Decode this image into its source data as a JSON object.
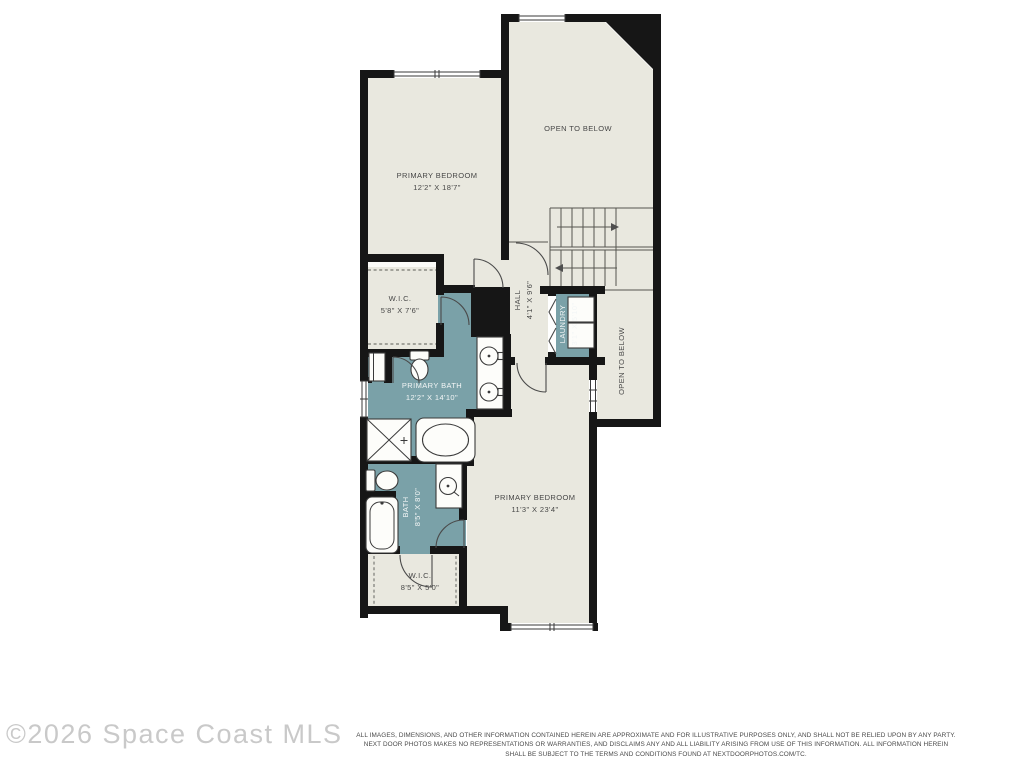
{
  "rooms": {
    "primary_bedroom_upper": {
      "name": "PRIMARY BEDROOM",
      "dims": "12'2\" X 18'7\""
    },
    "open_to_below_upper": {
      "name": "OPEN TO BELOW"
    },
    "wic_upper": {
      "name": "W.I.C.",
      "dims": "5'8\" X 7'6\""
    },
    "hall": {
      "name": "HALL",
      "dims": "4'1\" X 9'6\""
    },
    "laundry": {
      "name": "LAUNDRY",
      "dims": "3'1\" X 5'10\""
    },
    "open_to_below_right": {
      "name": "OPEN TO BELOW"
    },
    "primary_bath": {
      "name": "PRIMARY BATH",
      "dims": "12'2\" X 14'10\""
    },
    "bath": {
      "name": "BATH",
      "dims": "8'5\" X 8'0\""
    },
    "primary_bedroom_lower": {
      "name": "PRIMARY BEDROOM",
      "dims": "11'3\" X 23'4\""
    },
    "wic_lower": {
      "name": "W.I.C.",
      "dims": "8'5\" X 5'0\""
    }
  },
  "watermark": "©2026 Space Coast MLS",
  "disclaimer": {
    "line1": "ALL IMAGES, DIMENSIONS, AND OTHER INFORMATION CONTAINED HEREIN ARE APPROXIMATE AND FOR ILLUSTRATIVE PURPOSES ONLY, AND SHALL NOT BE RELIED UPON BY ANY PARTY.",
    "line2": "NEXT DOOR PHOTOS MAKES NO REPRESENTATIONS OR WARRANTIES, AND DISCLAIMS ANY AND ALL LIABILITY ARISING FROM USE OF THIS INFORMATION. ALL INFORMATION HEREIN",
    "line3": "SHALL BE SUBJECT TO THE TERMS AND CONDITIONS FOUND AT NEXTDOORPHOTOS.COM/TC."
  },
  "colors": {
    "wall": "#161616",
    "floor": "#e9e8df",
    "wet": "#7aa1a8",
    "ink": "#474747",
    "wmark": "#c9c9c9"
  }
}
